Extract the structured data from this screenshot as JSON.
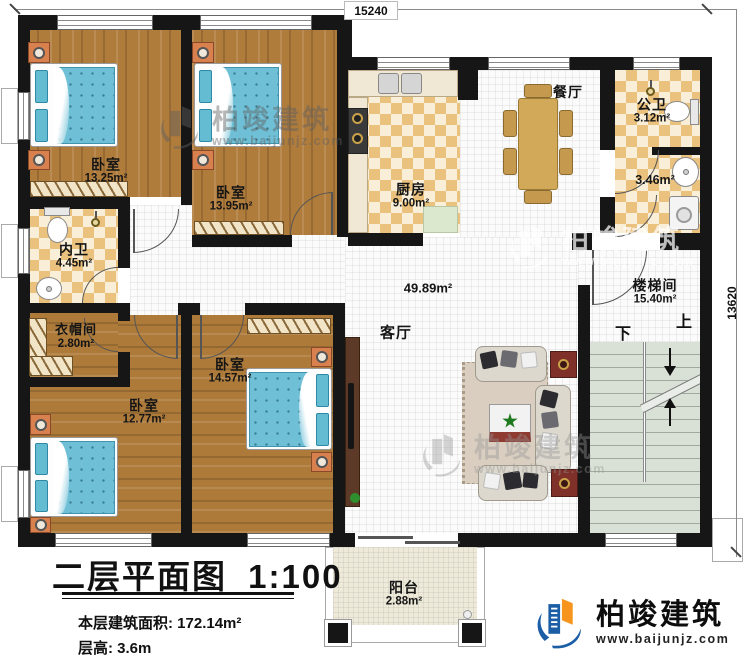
{
  "dimensions": {
    "top": "15240",
    "right": "13620"
  },
  "rooms": {
    "bedroom_top_left": {
      "name": "卧室",
      "area": "13.25m²"
    },
    "bedroom_top_mid": {
      "name": "卧室",
      "area": "13.95m²"
    },
    "kitchen": {
      "name": "厨房",
      "area": "9.00m²"
    },
    "dining": {
      "name": "餐厅"
    },
    "public_bath": {
      "name": "公卫",
      "area_upper": "3.12m²",
      "area_lower": "3.46m²"
    },
    "stairwell": {
      "name": "楼梯间",
      "area": "15.40m²",
      "up_label": "上",
      "down_label": "下"
    },
    "inner_bath": {
      "name": "内卫",
      "area": "4.45m²"
    },
    "cloakroom": {
      "name": "衣帽间",
      "area": "2.80m²"
    },
    "bedroom_bottom_left": {
      "name": "卧室",
      "area": "12.77m²"
    },
    "bedroom_bottom_mid": {
      "name": "卧室",
      "area": "14.57m²"
    },
    "living": {
      "name": "客厅",
      "area": "49.89m²"
    },
    "balcony": {
      "name": "阳台",
      "area": "2.88m²"
    }
  },
  "title_block": {
    "plan_title": "二层平面图",
    "scale": "1:100",
    "floor_area_label": "本层建筑面积:",
    "floor_area_value": "172.14m²",
    "floor_height_label": "层高:",
    "floor_height_value": "3.6m"
  },
  "branding": {
    "name": "柏竣建筑",
    "website": "www.baijunjz.com"
  },
  "colors": {
    "wall": "#161616",
    "wood_floor": "#b07c3c",
    "tile": "#eac17d",
    "mattress": "#6fc0d6",
    "logo_blue": "#1b5ea6",
    "logo_orange": "#f7941d"
  }
}
